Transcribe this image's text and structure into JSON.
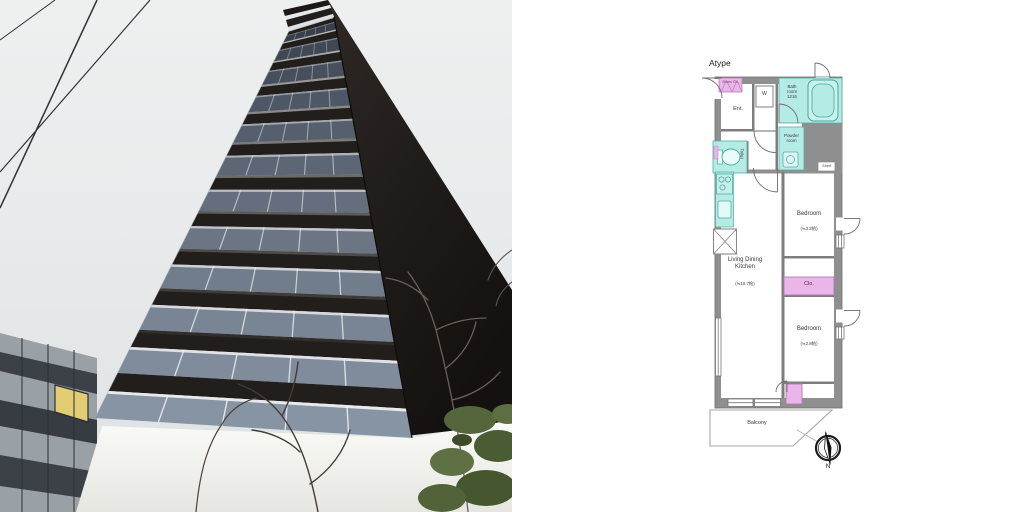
{
  "left_panel": {
    "type": "photograph",
    "description": "Low-angle exterior photo of a dark brown high-rise apartment tower with glass balcony panels against an overcast sky; power lines upper-left, neighboring low office building with one lit yellow window lower-left, bare branches and green foliage lower-right, white ground wall",
    "colors": {
      "sky": "#e9ebec",
      "tower_slab": "#221e1b",
      "tower_side": "#1d1917",
      "glass_low": "#8794a4",
      "lit_window": "#e3cd74",
      "ground_wall": "#f4f4f0"
    }
  },
  "floor_plan": {
    "plan_label": "Atype",
    "rooms": {
      "entrance": "Ent.",
      "shoes_cabinet": "Shoes Clo.",
      "washer": "W",
      "bathroom": "Bath\nroom\n1216",
      "powder_room": "Powder\nroom",
      "toilet": "Toilet",
      "ldk": "Living Dining\nKitchen",
      "ldk_size": "(≒10.7帖)",
      "bedroom1": "Bedroom",
      "bedroom1_size": "(≒3.2帖)",
      "closet": "Clo.",
      "bedroom2": "Bedroom",
      "bedroom2_size": "(≒2.8帖)",
      "shelf": "Shelf",
      "balcony": "Balcony"
    },
    "compass_label": "N",
    "colors": {
      "wall_gray": "#8f8f8f",
      "wet_area_teal": "#b5ebe5",
      "storage_pink": "#eab5e8",
      "fixture_border": "#56ada3"
    }
  }
}
